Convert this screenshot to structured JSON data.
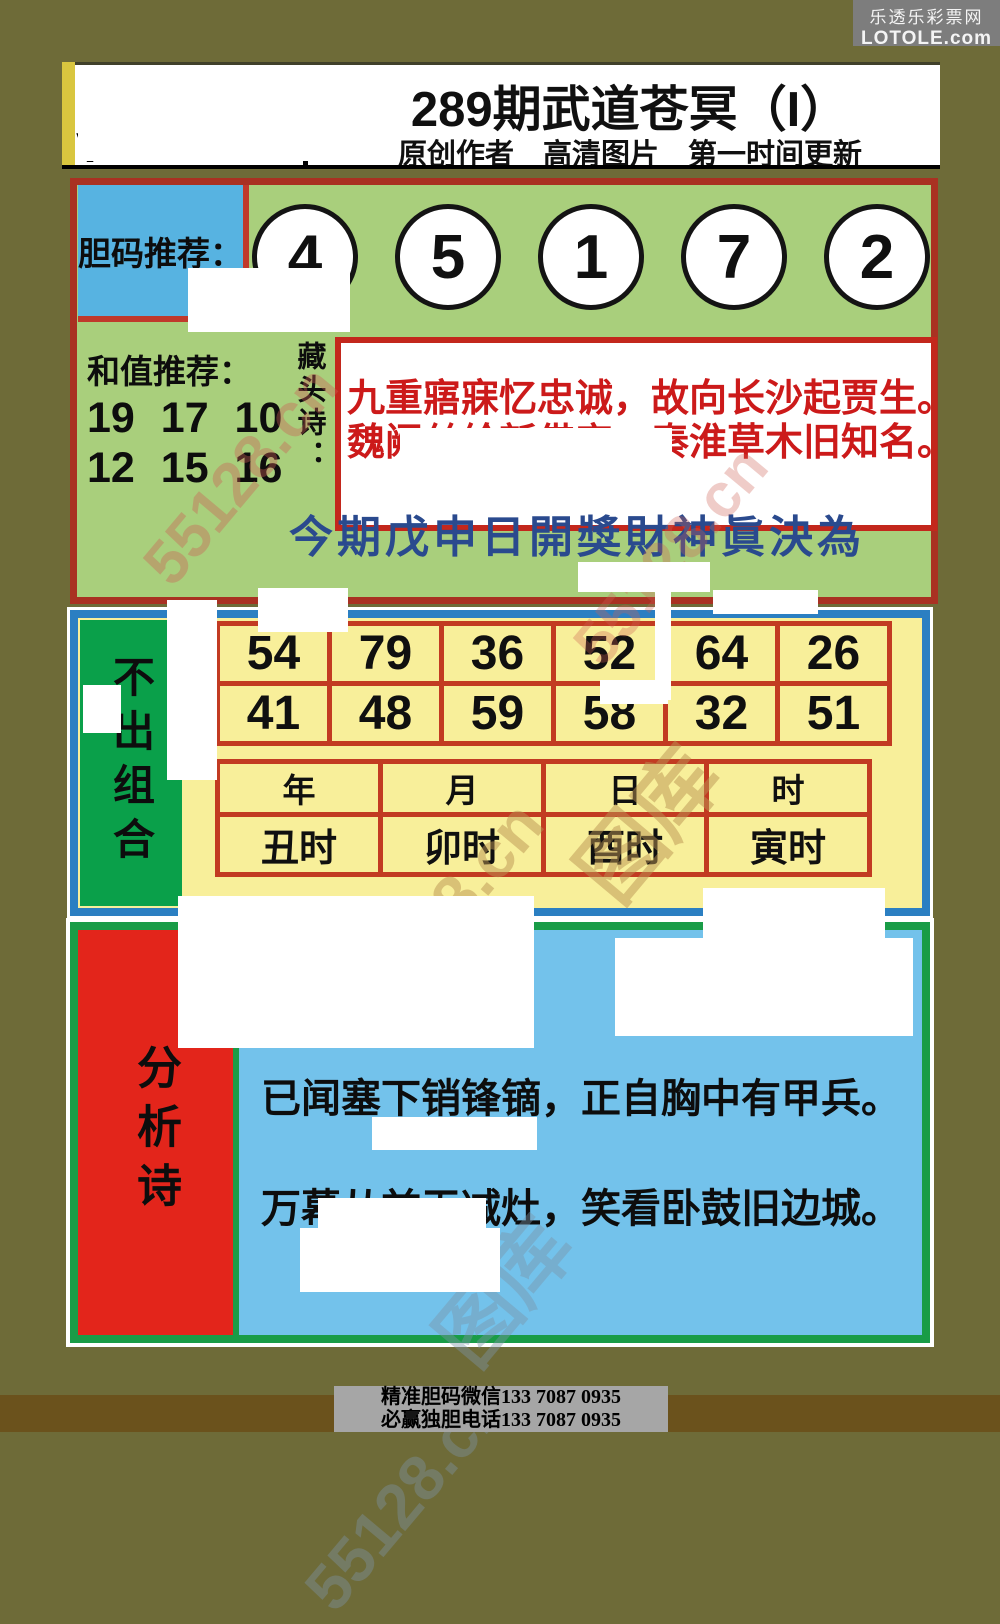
{
  "brand": {
    "site_name": "乐透乐彩票网",
    "site_url": "LOTOLE.com"
  },
  "header": {
    "title": "289期武道苍冥（I）",
    "subtitle": "原创作者　高清图片　第一时间更新",
    "remnant_mark": "V"
  },
  "top_panel": {
    "dan_label": "胆码推荐：",
    "dan_numbers": [
      "4",
      "5",
      "1",
      "7",
      "2"
    ],
    "hezhi_label": "和值推荐：",
    "hezhi_line1": "19 17 10",
    "hezhi_line2": "12 15 16",
    "cangtou_label": "藏头诗：",
    "poem_line1": "九重寤寐忆忠诚，故向长沙起贾生。",
    "poem_line2": "魏阙丝纶新借宠，秦淮草木旧知名。",
    "calligraphy": "今期戊申日開獎財神眞決為"
  },
  "middle_panel": {
    "sidebar_label": "不出组合",
    "number_rows": [
      [
        "54",
        "79",
        "36",
        "52",
        "64",
        "26"
      ],
      [
        "41",
        "48",
        "59",
        "58",
        "32",
        "51"
      ]
    ],
    "time_headers": [
      "年",
      "月",
      "日",
      "时"
    ],
    "time_values": [
      "丑时",
      "卯时",
      "酉时",
      "寅时"
    ]
  },
  "bottom_panel": {
    "sidebar_label": "分析诗",
    "poem_line1": "已闻塞下销锋镝，正自胸中有甲兵。",
    "poem_line2": "万幕从兹无减灶，笑看卧鼓旧边城。"
  },
  "footer": {
    "line1": "精准胆码微信133  7087  0935",
    "line2": "必赢独胆电话133  7087  0935"
  },
  "watermarks": [
    "55128.cn",
    "55128.cn",
    "图库",
    "55128.cn",
    "图库",
    "55128.cn"
  ],
  "colors": {
    "page_bg": "#6e6b38",
    "footer_strip": "#6b521c",
    "brand_bg": "#7d7d7d",
    "panel_border_red": "#a93122",
    "top_panel_green": "#a9cf7c",
    "dan_box_blue": "#57b3e1",
    "poem_red": "#cc1a1a",
    "calligraphy_blue": "#2a4a8e",
    "middle_border_blue": "#2b7fc2",
    "middle_bg_yellow": "#f8ef9a",
    "sidebar_green": "#0aa04a",
    "table_border_red": "#c23b22",
    "bottom_border_green": "#199c47",
    "bottom_bg_blue": "#73c2eb",
    "sidebar_red": "#e3251b",
    "footer_box_gray": "#a6a6a6"
  }
}
